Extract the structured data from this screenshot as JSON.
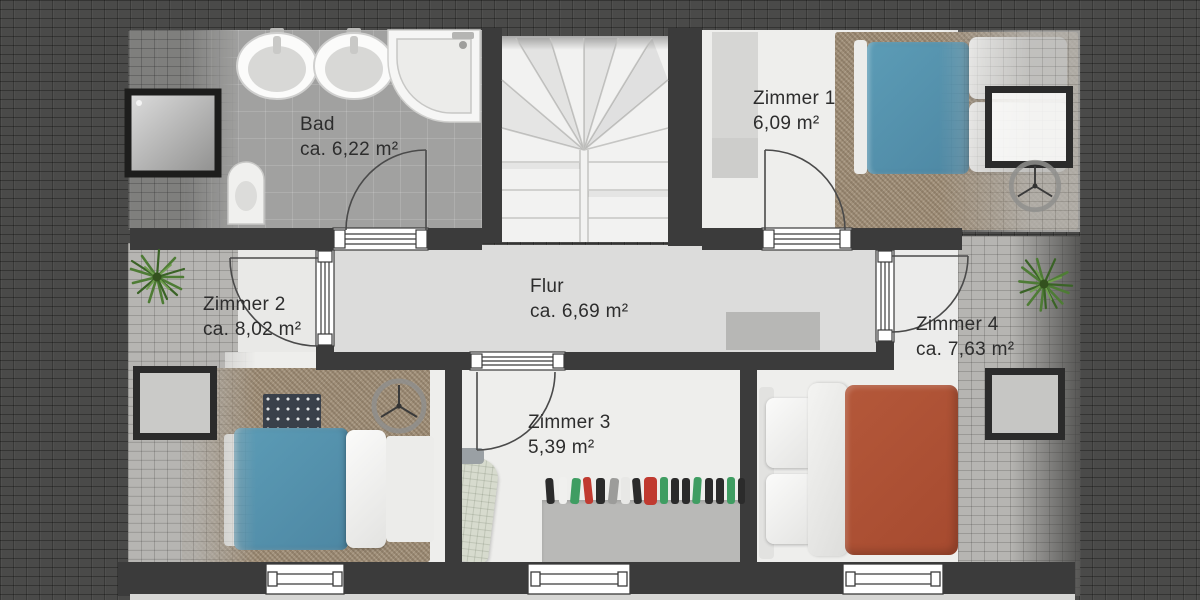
{
  "plan": {
    "type": "attic-floor-plan",
    "rooms": [
      {
        "name": "Bad",
        "area": "ca. 6,22 m²"
      },
      {
        "name": "Zimmer 1",
        "area": "6,09 m²"
      },
      {
        "name": "Zimmer 2",
        "area": "ca. 8,02 m²"
      },
      {
        "name": "Flur",
        "area": "ca. 6,69 m²"
      },
      {
        "name": "Zimmer 3",
        "area": "5,39 m²"
      },
      {
        "name": "Zimmer 4",
        "area": "ca. 7,63 m²"
      }
    ],
    "fixtures": [
      "winder-staircase",
      "shower",
      "washbasin-left",
      "washbasin-right",
      "corner-bathtub",
      "toilet",
      "wardrobe",
      "bed-blue-zimmer1",
      "bed-blue-zimmer2",
      "bed-orange-zimmer4",
      "roof-window-zimmer1",
      "roof-window-zimmer2",
      "roof-window-zimmer4",
      "ceiling-fan-zimmer1",
      "ceiling-fan-zimmer2",
      "doormat",
      "ironing-board",
      "clothes-rack",
      "plant-left",
      "plant-right",
      "window-zimmer2",
      "window-zimmer3",
      "window-zimmer4"
    ],
    "colors": {
      "wall": "#3b3b3b",
      "roof_dark": "#4a4a49",
      "roof_light": "#b6b5b2",
      "corridor_floor": "#dcdcdb",
      "room_floor": "#eeeeec",
      "bath_floor": "#a1a1a0",
      "carpet": "#a1907a",
      "bed_blue": "#5592ad",
      "bed_orange": "#b05134",
      "plant_green": "#4e7c35"
    }
  }
}
